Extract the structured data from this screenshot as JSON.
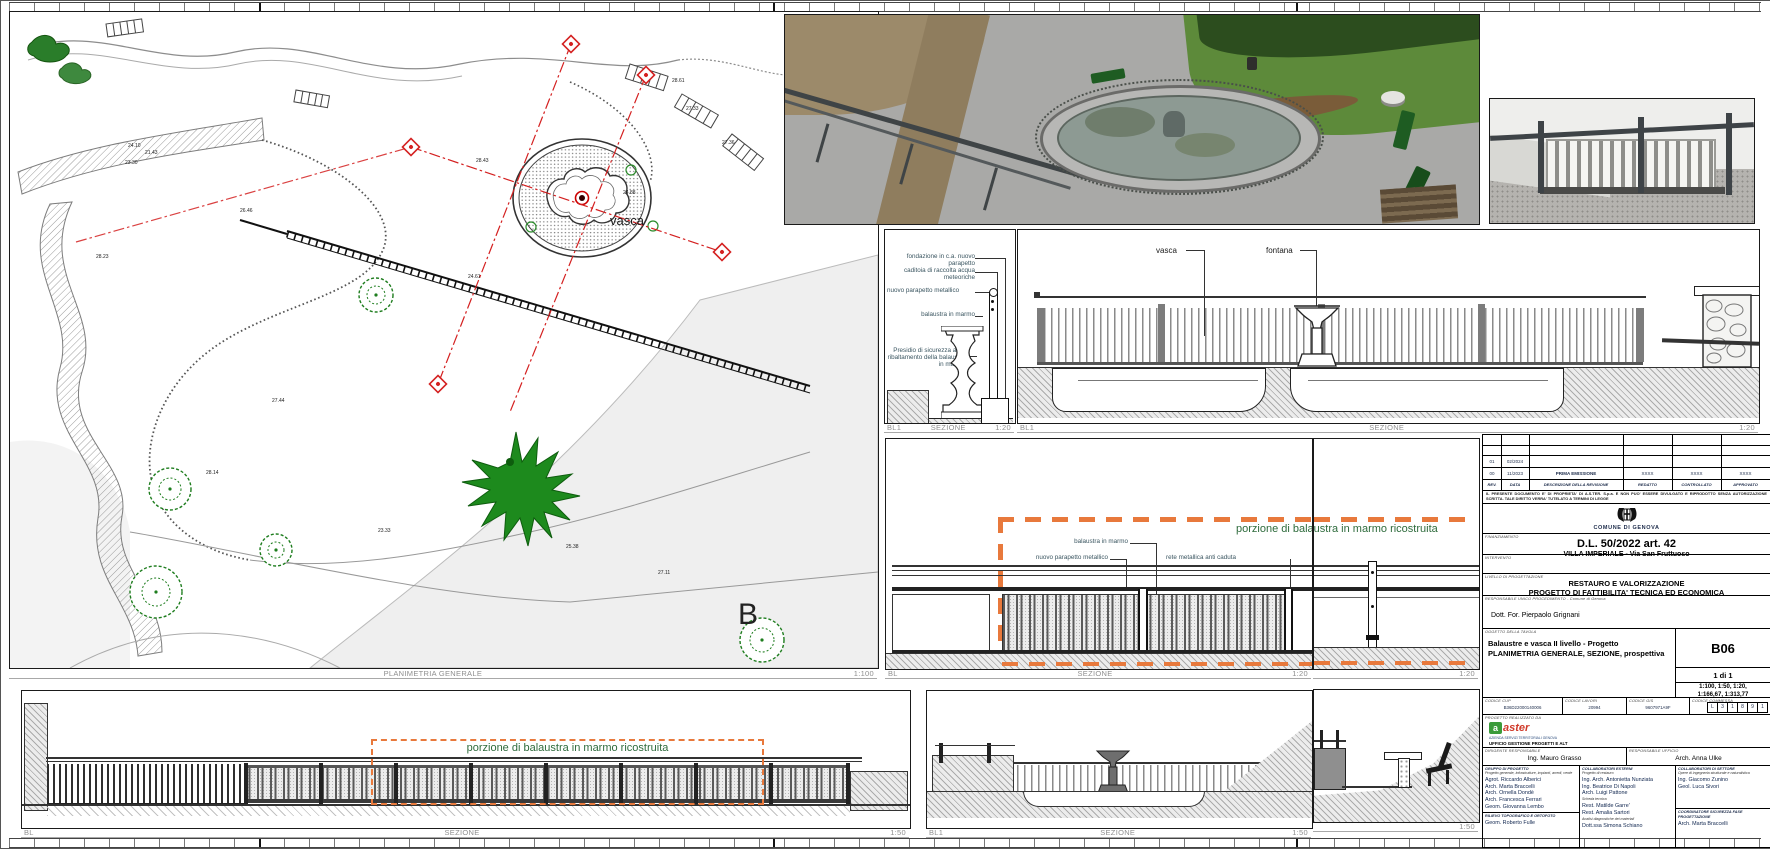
{
  "plan": {
    "title": "PLANIMETRIA GENERALE",
    "scale": "1:100",
    "label_vasca": "vasca",
    "label_b": "B",
    "spots": [
      "28.43",
      "24.88",
      "28.23",
      "27.44",
      "24.10",
      "23.30",
      "26.46",
      "21.43",
      "27.33",
      "28.14",
      "25.38",
      "27.11",
      "23.33",
      "28.61",
      "24.61",
      "27.36"
    ]
  },
  "detail": {
    "ref": "BL1",
    "title": "SEZIONE",
    "scale": "1:20",
    "annotations": [
      "fondazione in c.a. nuovo parapetto",
      "caditoia di raccolta acqua meteoriche",
      "nuovo parapetto metallico",
      "balaustra in marmo",
      "Presidio di sicurezza anti-ribaltamento della balaustra in marmo"
    ]
  },
  "long_section": {
    "ref": "BL1",
    "title": "SEZIONE",
    "scale": "1:20",
    "label_vasca": "vasca",
    "label_fontana": "fontana"
  },
  "mid_section": {
    "ref": "BL",
    "title": "SEZIONE",
    "scale": "1:20",
    "note": "porzione di balaustra in marmo ricostruita",
    "annotations": [
      "balaustra in marmo",
      "nuovo parapetto metallico",
      "rete metallica anti caduta"
    ]
  },
  "cont_section": {
    "scale": "1:20"
  },
  "elevation": {
    "ref": "BL",
    "title": "SEZIONE",
    "scale": "1:50",
    "note": "porzione di balaustra in marmo ricostruita"
  },
  "bottom_section": {
    "ref": "BL1",
    "title": "SEZIONE",
    "scale": "1:50"
  },
  "bench_section": {
    "scale": "1:50"
  },
  "colors": {
    "accent_orange": "#E8793C",
    "note_green": "#2E6B3C",
    "section_red": "#D42020"
  },
  "titleblock": {
    "revision": {
      "headers": [
        "REV.",
        "DATA",
        "DESCRIZIONE DELLA REVISIONE",
        "REDATTO",
        "CONTROLLATO",
        "APPROVATO"
      ],
      "rows": [
        {
          "rev": "01",
          "date": "02/2024",
          "desc": "",
          "red": "",
          "con": "",
          "app": ""
        },
        {
          "rev": "00",
          "date": "11/2023",
          "desc": "PRIMA EMISSIONE",
          "red": "XXXX",
          "con": "XXXX",
          "app": "XXXX"
        }
      ]
    },
    "disclaimer": "IL PRESENTE DOCUMENTO E' DI PROPRIETA' DI A.S.TER. S.p.a. E NON PUO' ESSERE DIVULGATO E RIPRODOTTO SENZA AUTORIZZAZIONE SCRITTA. TALE DIRITTO VERRA' TUTELATO A TERMINI DI LEGGE",
    "municipality": "COMUNE DI GENOVA",
    "financing_label": "FINANZIAMENTO",
    "financing_1": "D.L. 50/2022 art. 42",
    "financing_2": "VILLA IMPERIALE - Via San Fruttuoso",
    "intervento_label": "INTERVENTO",
    "level_label": "LIVELLO DI PROGETTAZIONE",
    "level_1": "RESTAURO E VALORIZZAZIONE",
    "level_2": "PROGETTO DI FATTIBILITA' TECNICA ED ECONOMICA",
    "rup_label": "RESPONSABILE UNICO PROCEDIMENTO - Comune di Genova",
    "rup_name": "Dott. For. Pierpaolo Grignani",
    "subject_label": "OGGETTO DELLA TAVOLA",
    "subject_1": "Balaustre e vasca II livello - Progetto",
    "subject_2": "PLANIMETRIA GENERALE, SEZIONE, prospettiva",
    "sheet_code": "B06",
    "sheet_count": "1 di 1",
    "scales_1": "1:100, 1:50, 1:20,",
    "scales_2": "1:166,67, 1:313,77",
    "codes": [
      {
        "label": "CODICE CUP",
        "value": "B36D22000140006"
      },
      {
        "label": "CODICE LAVORI",
        "value": "20994"
      },
      {
        "label": "CODICE GIS",
        "value": "9607971A9F"
      },
      {
        "label": "CODICE COMMESSA",
        "value": ""
      }
    ],
    "commessa_boxes": [
      "L",
      "3",
      "1",
      "8",
      "9",
      "1"
    ],
    "made_by_label": "PROGETTO REALIZZATO DA",
    "aster_name": "aster",
    "aster_tagline": "AZIENDA SERVIZI TERRITORIALI GENOVA",
    "aster_office": "UFFICIO GESTIONE PROGETTI E ALT",
    "dirigente_label": "DIRIGENTE RESPONSABILE",
    "dirigente": "Ing. Mauro Grasso",
    "resp_ufficio_label": "RESPONSABILE UFFICIO",
    "resp_ufficio": "Arch. Anna Ulke",
    "gruppo_label": "GRUPPO DI PROGETTO",
    "gruppo_sub": "Progetto generale, infrastrutture, impianti, arredi, verde",
    "gruppo": [
      "Agrot. Riccardo Alberici",
      "Arch. Marta Braccelli",
      "Arch. Ornella Dondè",
      "Arch. Francesca Ferrari",
      "Geom. Giovanna Lembo"
    ],
    "rilievo_label": "RILIEVO TOPOGRAFICO E ORTOFOTO",
    "rilievo": "Geom. Roberto Fulle",
    "esterni_label": "COLLABORATORI ESTERNI",
    "esterni_sub1": "Progetto di restauro",
    "esterni_1": [
      "Ing. Arch. Antonietta Nunziata",
      "Ing. Beatrice Di Napoli",
      "Arch. Luigi Pattone"
    ],
    "esterni_sub2": "Scheda tecnica",
    "esterni_2": [
      "Rest. Matilde Garre'",
      "Rest. Amalia Sartori"
    ],
    "esterni_sub3": "Analisi diagnostiche dei materiali",
    "esterni_3": [
      "Dott.ssa Simona Schiano"
    ],
    "settore_label": "COLLABORATORI DI SETTORE",
    "settore_sub": "Opere di ingegneria strutturale e naturalistica",
    "settore": [
      "Ing. Giacomo Zunino",
      "Geol. Luca Sivori"
    ],
    "coord_label": "COORDINATORE SICUREZZA FASE PROGETTAZIONE",
    "coord": "Arch. Marta Braccelli"
  }
}
